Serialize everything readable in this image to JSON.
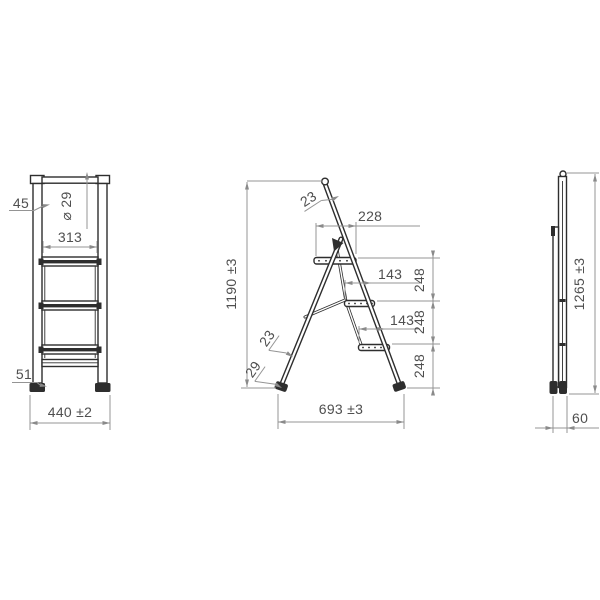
{
  "views": {
    "front": {
      "dims": {
        "rail_width": "45",
        "tube_diameter": "⌀ 29",
        "inner_step_width": "313",
        "foot_height": "51",
        "overall_width": "440 ±2"
      }
    },
    "side": {
      "dims": {
        "top_rail_thickness": "23",
        "platform_depth": "228",
        "overall_height": "1190 ±3",
        "step_depths": [
          "143",
          "143"
        ],
        "step_spacings": [
          "248",
          "248",
          "248"
        ],
        "front_rail_thickness": "23",
        "foot_depth": "29",
        "base_spread": "693 ±3"
      }
    },
    "folded": {
      "dims": {
        "folded_height": "1265 ±3",
        "folded_depth": "60"
      }
    }
  },
  "colors": {
    "background": "#ffffff",
    "object_line": "#2e2e2e",
    "dimension_line": "#949494",
    "dimension_text": "#4f4f4f"
  }
}
